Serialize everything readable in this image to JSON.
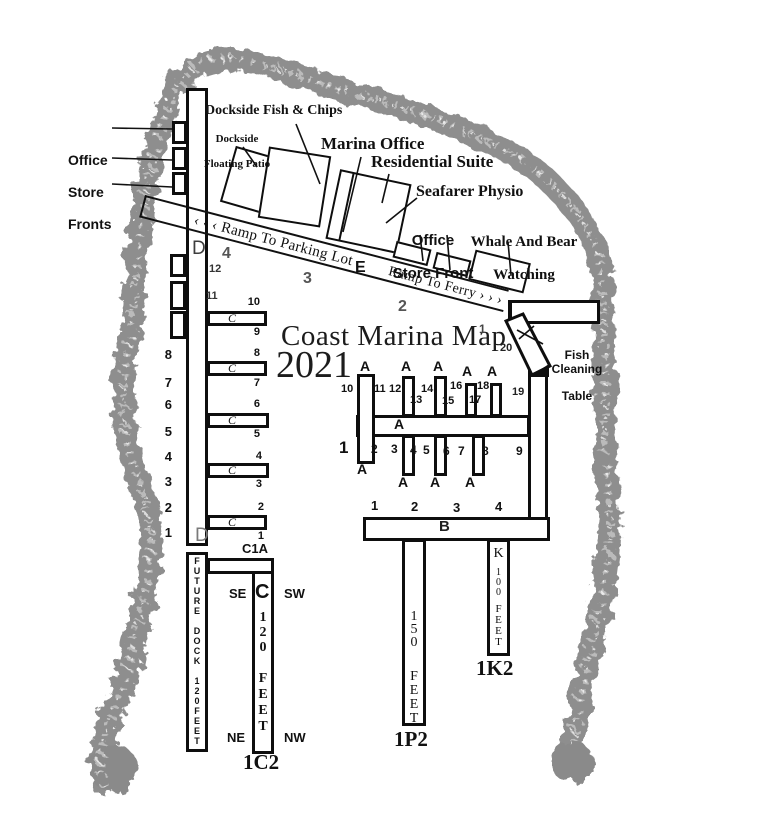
{
  "title": {
    "text": "Coast Marina Map",
    "year": "2021"
  },
  "pois": {
    "office_store_fronts": {
      "l1": "Office",
      "l2": "Store",
      "l3": "Fronts"
    },
    "dockside_fish_chips": "Dockside Fish & Chips",
    "dockside_floating_patio": {
      "l1": "Dockside",
      "l2": "Floating Patio"
    },
    "marina_office": "Marina Office",
    "residential_suite": "Residential Suite",
    "seafarer_physio": "Seafarer Physio",
    "office_store_front": {
      "l1": "Office",
      "l2": "Store Front"
    },
    "whale_and_bear_watching": {
      "l1": "Whale And Bear",
      "l2": "Watching"
    },
    "fish_cleaning_table": {
      "l1": "Fish Cleaning",
      "l2": "Table"
    }
  },
  "ramp": {
    "parking": "‹ ‹ ‹ Ramp To Parking Lot",
    "ferry": "Ramp To Ferry › › ›",
    "e": "E",
    "n4": "4",
    "n3": "3",
    "n2": "2",
    "n1": "1",
    "n20": "20",
    "n19": "19"
  },
  "dock_d": {
    "top": "D",
    "bottom": "D",
    "n12": "12",
    "n11": "11",
    "left": [
      "8",
      "7",
      "6",
      "5",
      "4",
      "3",
      "2",
      "1"
    ]
  },
  "dock_c": {
    "c1a": "C1A",
    "tag": "1C2",
    "letter": "C",
    "finger_letter": "C",
    "se": "SE",
    "sw": "SW",
    "ne": "NE",
    "nw": "NW",
    "len": "1\n2\n0",
    "feet": "F\nE\nE\nT",
    "fingers": [
      [
        "10",
        "9"
      ],
      [
        "8",
        "7"
      ],
      [
        "6",
        "5"
      ],
      [
        "4",
        "3"
      ],
      [
        "2",
        "1"
      ]
    ]
  },
  "dock_a": {
    "letter": "A",
    "top_nums": [
      "10",
      "11",
      "12",
      "13",
      "14",
      "15",
      "16",
      "17",
      "18"
    ],
    "bot_nums": [
      "1",
      "2",
      "3",
      "4",
      "5",
      "6",
      "7",
      "8",
      "9"
    ]
  },
  "dock_b": {
    "letter": "B",
    "nums": [
      "1",
      "2",
      "3",
      "4"
    ]
  },
  "dock_p": {
    "len": "1\n5\n0",
    "feet": "F\nE\nE\nT",
    "tag": "1P2"
  },
  "dock_k": {
    "letter": "K",
    "len": "1\n0\n0",
    "feet": "F\nE\nE\nT",
    "tag": "1K2"
  },
  "future_dock": "F\nU\nT\nU\nR\nE\n \nD\nO\nC\nK\n \n1\n2\n0\nF\nE\nE\nT"
}
